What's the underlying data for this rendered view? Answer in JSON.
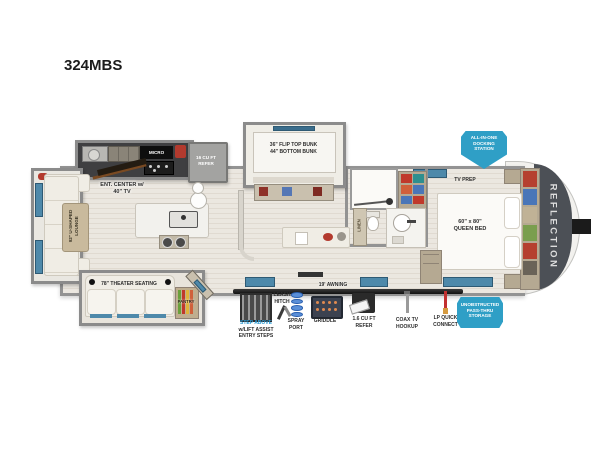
{
  "title": "324MBS",
  "brand": "REFLECTION",
  "badges": {
    "docking": [
      "ALL-IN-ONE",
      "DOCKING",
      "STATION"
    ],
    "storage": [
      "UNOBSTRUCTED",
      "PASS-THRU",
      "STORAGE"
    ]
  },
  "rooms": {
    "micro": "MICRO",
    "refer": [
      "16 CU FT",
      "REFER"
    ],
    "ent_center": [
      "ENT. CENTER w/",
      "40\" TV"
    ],
    "bunk": [
      "36\" FLIP TOP BUNK",
      "44\" BOTTOM BUNK"
    ],
    "tv_prep": "TV PREP",
    "queen_bed": [
      "60\" x 80\"",
      "QUEEN BED"
    ],
    "lounge": [
      "92\" U-SHAPED",
      "LOUNGE"
    ],
    "theater": "78\" THEATER SEATING",
    "pantry": "PANTRY",
    "linen": "LINEN",
    "awning": "19' AWNING"
  },
  "exterior": {
    "steps": [
      "STEP ABOVE",
      "w/LIFT ASSIST",
      "ENTRY STEPS"
    ],
    "leash": [
      "LEASH",
      "HITCH"
    ],
    "spray": [
      "SPRAY",
      "PORT"
    ],
    "griddle": "GRIDDLE",
    "mini_refer": [
      "1.6 CU FT",
      "REFER"
    ],
    "coax": [
      "COAX TV",
      "HOOKUP"
    ],
    "lp": [
      "LP QUICK",
      "CONNECT"
    ]
  },
  "colors": {
    "accent_blue": "#2f9fc6",
    "step_highlight_blue": "#2b9cd6",
    "front_cap": "#4c5056",
    "wall_gray": "#939393",
    "window_blue": "#4e89aa",
    "floor_light": "#ebe7e0",
    "floor_dark": "#e0dad1",
    "cabinet_tan": "#b5a992",
    "sofa_cream": "#f0ede5"
  }
}
